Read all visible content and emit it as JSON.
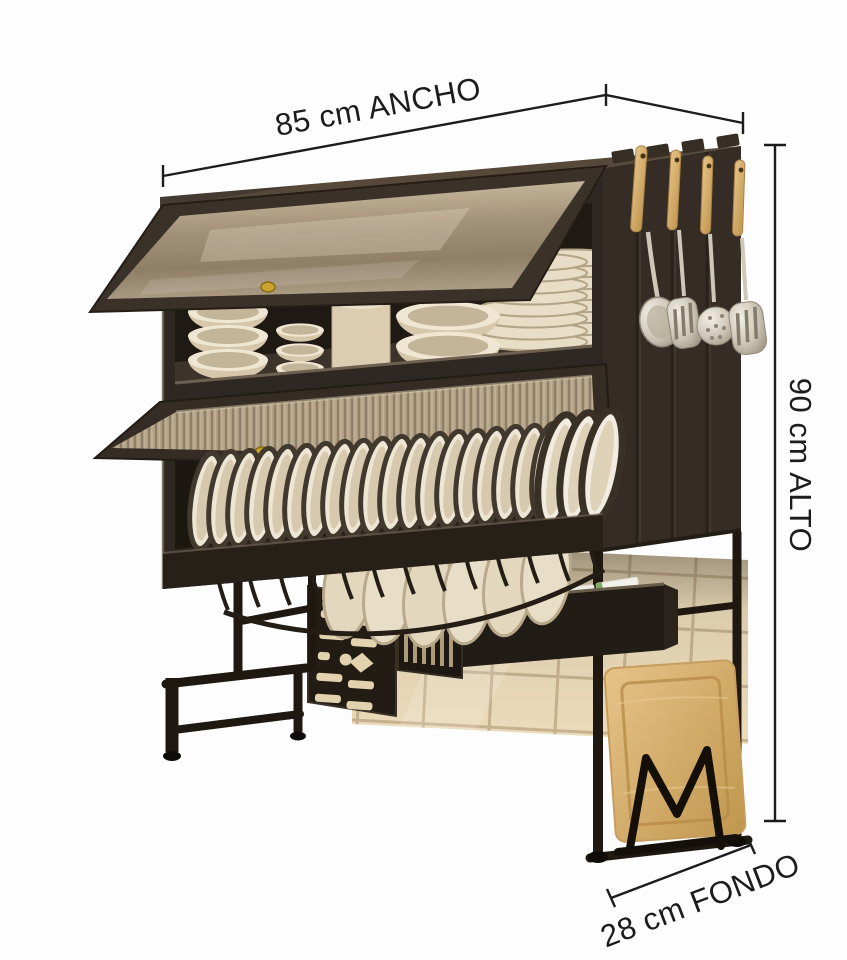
{
  "page": {
    "background": "#fdfdfd",
    "width_px": 847,
    "height_px": 960
  },
  "annotations": {
    "line_color": "#1c1c1c",
    "width": {
      "label": "85 cm ANCHO",
      "value_cm": 85
    },
    "height": {
      "label": "90 cm ALTO",
      "value_cm": 90
    },
    "depth": {
      "label": "28 cm FONDO",
      "value_cm": 28
    }
  },
  "product": {
    "parts": [
      "two-tier-dish-cabinet",
      "frosted-flip-up-door",
      "ribbed-glass-flip-up-door",
      "vertical-plate-rack-row",
      "bowl-and-plate-stacks",
      "hanging-utensils",
      "utensil-cage",
      "perforated-knife-holder-panel",
      "storage-tray-shelf",
      "detergent-jug",
      "storage-boxes",
      "wire-plate-basket",
      "ladder-legs",
      "wooden-cutting-board",
      "m-shaped-board-holder",
      "tile-backsplash"
    ]
  },
  "palette": {
    "background": "#fdfdfd",
    "annotation": "#1c1c1c",
    "cabinet_front": "#2f2822",
    "cabinet_side": "#352d25",
    "cabinet_top": "#57493a",
    "cabinet_interior": "#1f1913",
    "glass_smoky": "#ab9b80",
    "glass_ribbed": "#b3a285",
    "dish_cream": "#ddd0b6",
    "dish_white": "#efe9dc",
    "dish_rim_dark": "#42392e",
    "wood": "#d5ad6d",
    "steel": "#cdc5b6",
    "tile": "#ecdcbb",
    "tile_grout": "#c8b390",
    "metal_black": "#1e1811",
    "brass_knob": "#caa22e",
    "label_green": "#7cab65"
  }
}
